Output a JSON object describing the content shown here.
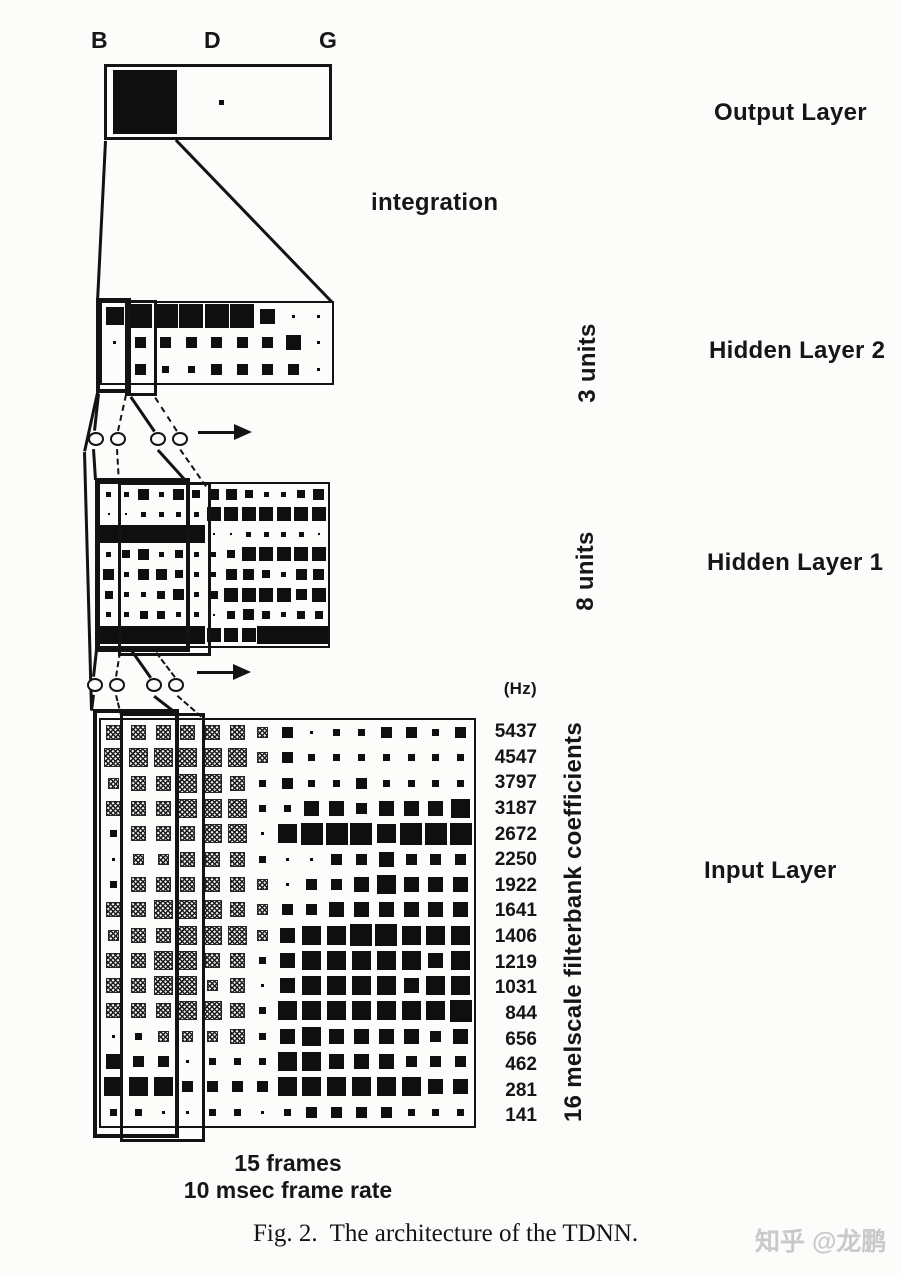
{
  "figure": {
    "phonemes": [
      "B",
      "D",
      "G"
    ],
    "integration_label": "integration",
    "hz_label": "(Hz)",
    "frequencies": [
      "5437",
      "4547",
      "3797",
      "3187",
      "2672",
      "2250",
      "1922",
      "1641",
      "1406",
      "1219",
      "1031",
      "844",
      "656",
      "462",
      "281",
      "141"
    ],
    "layers": {
      "output": {
        "label": "Output Layer"
      },
      "hidden2": {
        "label": "Hidden Layer 2",
        "units_label": "3 units"
      },
      "hidden1": {
        "label": "Hidden Layer 1",
        "units_label": "8 units"
      },
      "input": {
        "label": "Input Layer",
        "coeff_label": "16 melscale filterbank coefficients"
      }
    },
    "footer": {
      "frames": "15 frames",
      "rate": "10 msec frame rate"
    },
    "caption": "Fig. 2.  The architecture of the TDNN.",
    "watermark": "知乎 @龙鹏",
    "colors": {
      "ink": "#131313",
      "paper": "#fcfcfa",
      "watermark": "#c9c9c9"
    },
    "weights": {
      "output": [
        5,
        0,
        -1
      ],
      "hidden2": [
        [
          5,
          5,
          5,
          5,
          5,
          5,
          3,
          0,
          0
        ],
        [
          0,
          2,
          2,
          2,
          2,
          2,
          2,
          3,
          0
        ],
        [
          -1,
          2,
          1,
          1,
          2,
          2,
          2,
          2,
          0
        ]
      ],
      "hidden1": [
        [
          1,
          1,
          3,
          1,
          3,
          2,
          3,
          3,
          2,
          1,
          1,
          2,
          3
        ],
        [
          0,
          0,
          1,
          1,
          1,
          1,
          4,
          4,
          4,
          4,
          4,
          4,
          4
        ],
        [
          5,
          5,
          5,
          5,
          5,
          5,
          0,
          0,
          1,
          1,
          1,
          1,
          0
        ],
        [
          1,
          2,
          3,
          1,
          2,
          1,
          1,
          2,
          4,
          4,
          4,
          4,
          4
        ],
        [
          3,
          1,
          3,
          3,
          2,
          1,
          1,
          3,
          3,
          2,
          1,
          3,
          3
        ],
        [
          2,
          1,
          1,
          2,
          3,
          1,
          2,
          4,
          4,
          4,
          4,
          3,
          4
        ],
        [
          1,
          1,
          2,
          2,
          1,
          1,
          0,
          2,
          3,
          2,
          1,
          2,
          2
        ],
        [
          5,
          5,
          5,
          5,
          5,
          5,
          4,
          4,
          4,
          5,
          5,
          5,
          5
        ]
      ],
      "input": [
        [
          3,
          3,
          3,
          3,
          3,
          3,
          2,
          2,
          0,
          1,
          1,
          2,
          2,
          1,
          2
        ],
        [
          4,
          4,
          4,
          4,
          4,
          4,
          2,
          2,
          1,
          1,
          1,
          1,
          1,
          1,
          1
        ],
        [
          2,
          3,
          3,
          4,
          4,
          3,
          1,
          2,
          1,
          1,
          2,
          1,
          1,
          1,
          1
        ],
        [
          3,
          3,
          3,
          4,
          4,
          4,
          1,
          1,
          3,
          3,
          2,
          3,
          3,
          3,
          4
        ],
        [
          1,
          3,
          3,
          3,
          4,
          4,
          0,
          4,
          5,
          5,
          5,
          4,
          5,
          5,
          5
        ],
        [
          0,
          2,
          2,
          3,
          3,
          3,
          1,
          0,
          0,
          2,
          2,
          3,
          2,
          2,
          2
        ],
        [
          1,
          3,
          3,
          3,
          3,
          3,
          2,
          0,
          2,
          2,
          3,
          4,
          3,
          3,
          3
        ],
        [
          3,
          3,
          4,
          4,
          4,
          3,
          2,
          2,
          2,
          3,
          3,
          3,
          3,
          3,
          3
        ],
        [
          2,
          3,
          3,
          4,
          4,
          4,
          2,
          3,
          4,
          4,
          5,
          5,
          4,
          4,
          4
        ],
        [
          3,
          3,
          4,
          4,
          3,
          3,
          1,
          3,
          4,
          4,
          4,
          4,
          4,
          3,
          4
        ],
        [
          3,
          3,
          4,
          4,
          2,
          3,
          0,
          3,
          4,
          4,
          4,
          4,
          3,
          4,
          4
        ],
        [
          3,
          3,
          3,
          4,
          4,
          3,
          1,
          4,
          4,
          4,
          4,
          4,
          4,
          4,
          5
        ],
        [
          0,
          1,
          2,
          2,
          2,
          3,
          1,
          3,
          4,
          3,
          3,
          3,
          3,
          2,
          3
        ],
        [
          3,
          2,
          2,
          0,
          1,
          1,
          1,
          4,
          4,
          3,
          3,
          3,
          2,
          2,
          2
        ],
        [
          4,
          4,
          4,
          2,
          2,
          2,
          2,
          4,
          4,
          4,
          4,
          4,
          4,
          3,
          3
        ],
        [
          1,
          1,
          0,
          0,
          1,
          1,
          0,
          1,
          2,
          2,
          2,
          2,
          1,
          1,
          1
        ]
      ],
      "input_hatched_cols": 7,
      "input_solid_rows": [
        13,
        14
      ]
    }
  }
}
